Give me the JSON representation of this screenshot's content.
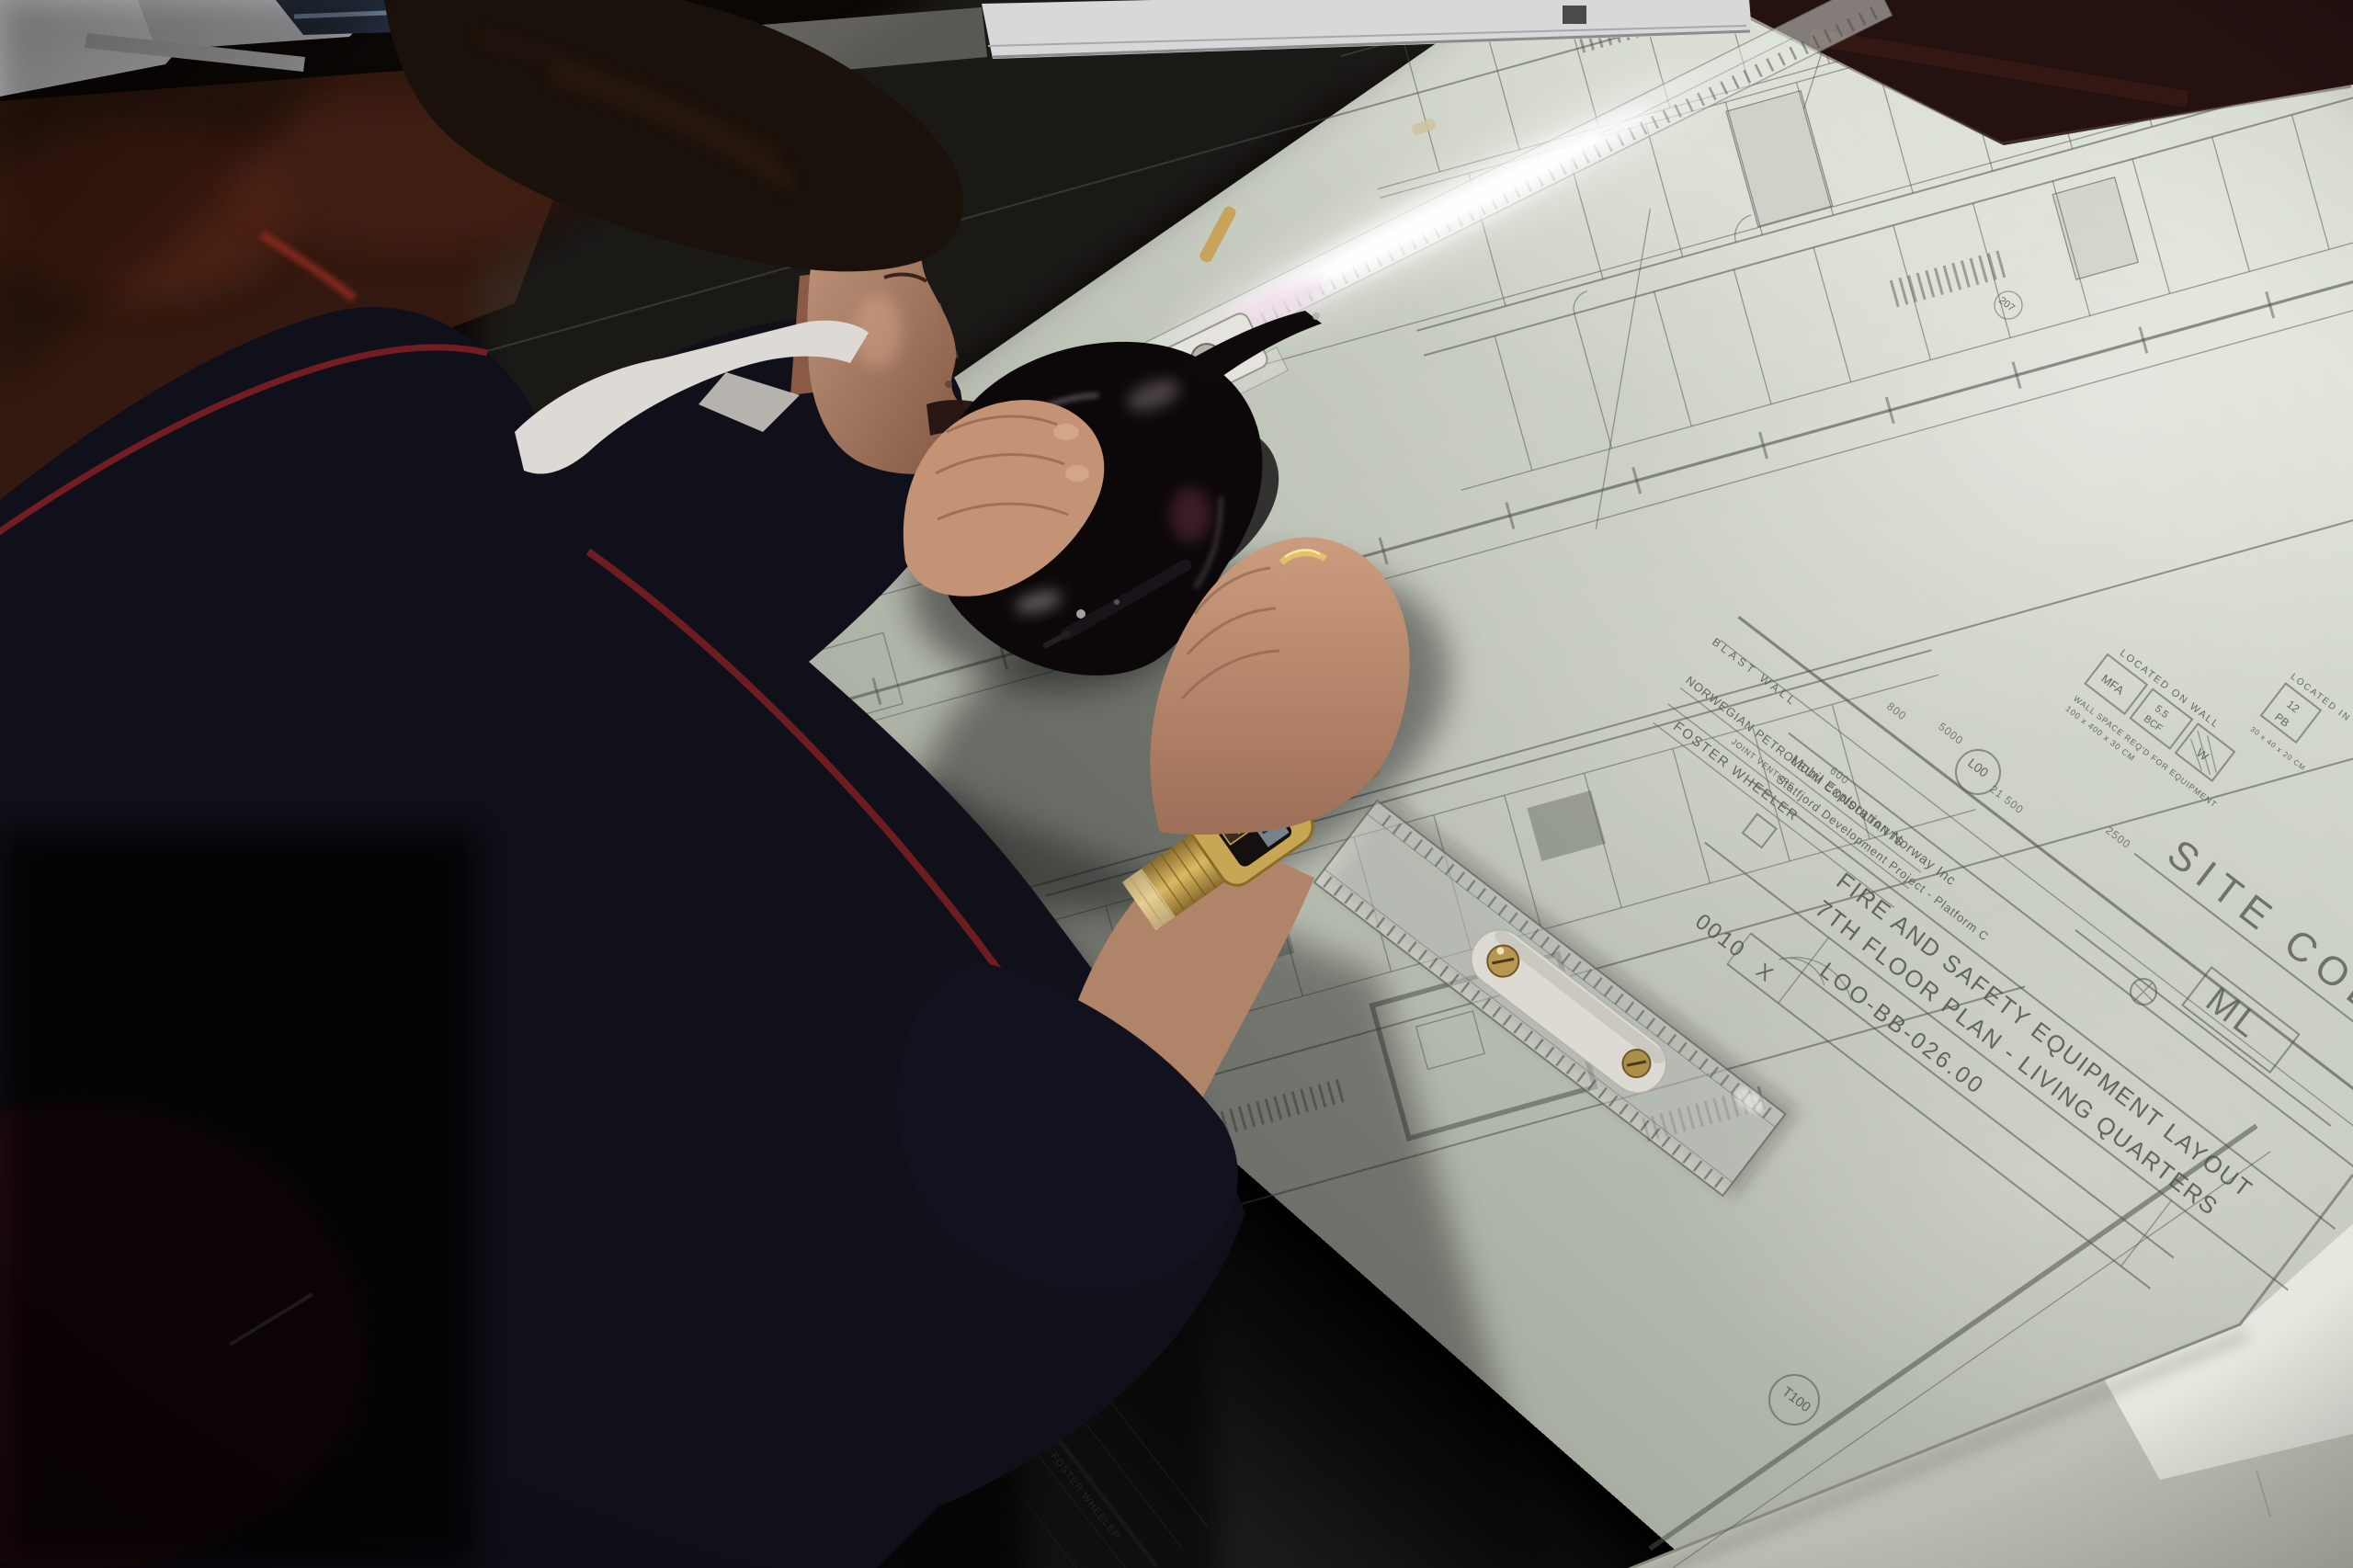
{
  "title_block": {
    "company": "Mobil Exploration Norway Inc",
    "project": "Statfjord Development Project - Platform C",
    "title1": "FIRE AND SAFETY EQUIPMENT LAYOUT",
    "title2": "7TH FLOOR PLAN - LIVING QUARTERS",
    "drawing_no": "LOO-BB-026.00",
    "rev": "X",
    "code": "0010",
    "site_code_label": "SITE CODE",
    "site_code_value": "ML"
  },
  "stamp": {
    "line1": "NORWEGIAN PETROLEUM CONSULTANTS",
    "line2": "JOINT VENTURE",
    "line3": "FOSTER WHEELER",
    "blast_wall": "BLAST WALL",
    "under_sheet": "NORWEGIAN PETROLEUM CONSULTANTS — FOSTER WHEELER"
  },
  "callouts": {
    "located_on_wall": "LOCATED ON WALL",
    "located_in_wall": "LOCATED IN WALL",
    "box_mfa": "MFA",
    "box_bcf_top": "5.5",
    "box_bcf_bottom": "BCF",
    "box_w": "W",
    "box_pb_top": "12",
    "box_pb_bottom": "PB",
    "note_wall_space": "WALL SPACE REQ'D FOR EQUIPMENT",
    "note_dims": "100 x 400 x 30 CM",
    "note_dims2": "30 x 40 x 20 CM"
  },
  "bubbles": {
    "t100": "T100",
    "l00": "L00",
    "room": "207"
  },
  "dims": {
    "d1": "5000",
    "d2": "21 500",
    "d3": "800",
    "d4": "2500",
    "d5": "600"
  },
  "colors": {
    "sheet": "#ccd1c5",
    "line": "#4b514b",
    "sweater": "#10101a",
    "piping": "#7e1e22",
    "skin": "#c59a80",
    "gold": "#c7a654",
    "chair": "#461114"
  }
}
